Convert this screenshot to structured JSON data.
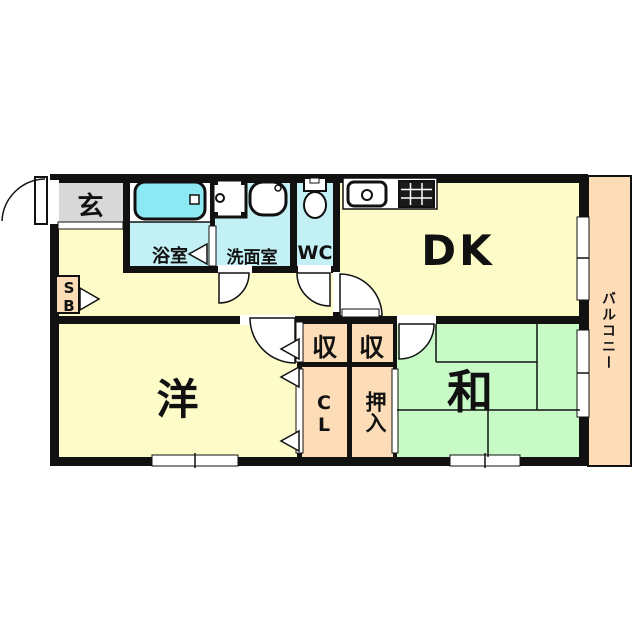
{
  "title": "apartment-floor-plan",
  "plan": {
    "labels": {
      "entrance": "玄",
      "bath": "浴室",
      "washroom": "洗面室",
      "wc": "WC",
      "dk": "DK",
      "balcony": "バルコニー",
      "western_room": "洋",
      "japanese_room": "和",
      "storage_left": "収",
      "storage_right": "収",
      "closet": "CL",
      "oshiire": "押入",
      "shoe_box": "SB"
    },
    "colors": {
      "room_yellow": "#fdfbc8",
      "tatami_green": "#c8fac6",
      "balcony_salmon": "#fddcb8",
      "water_cyan": "#c3f0f5",
      "bathtub_cyan": "#8ce8f2",
      "entrance_gray": "#d8d8d8",
      "wall_black": "#111111",
      "background": "#ffffff"
    },
    "fixtures": {
      "bathtub": "bathtub-icon",
      "washing_machine": "washing-machine-icon",
      "wash_basin": "wash-basin-icon",
      "toilet": "toilet-icon",
      "kitchen_sink": "kitchen-sink-icon",
      "stove": "stove-icon"
    }
  }
}
